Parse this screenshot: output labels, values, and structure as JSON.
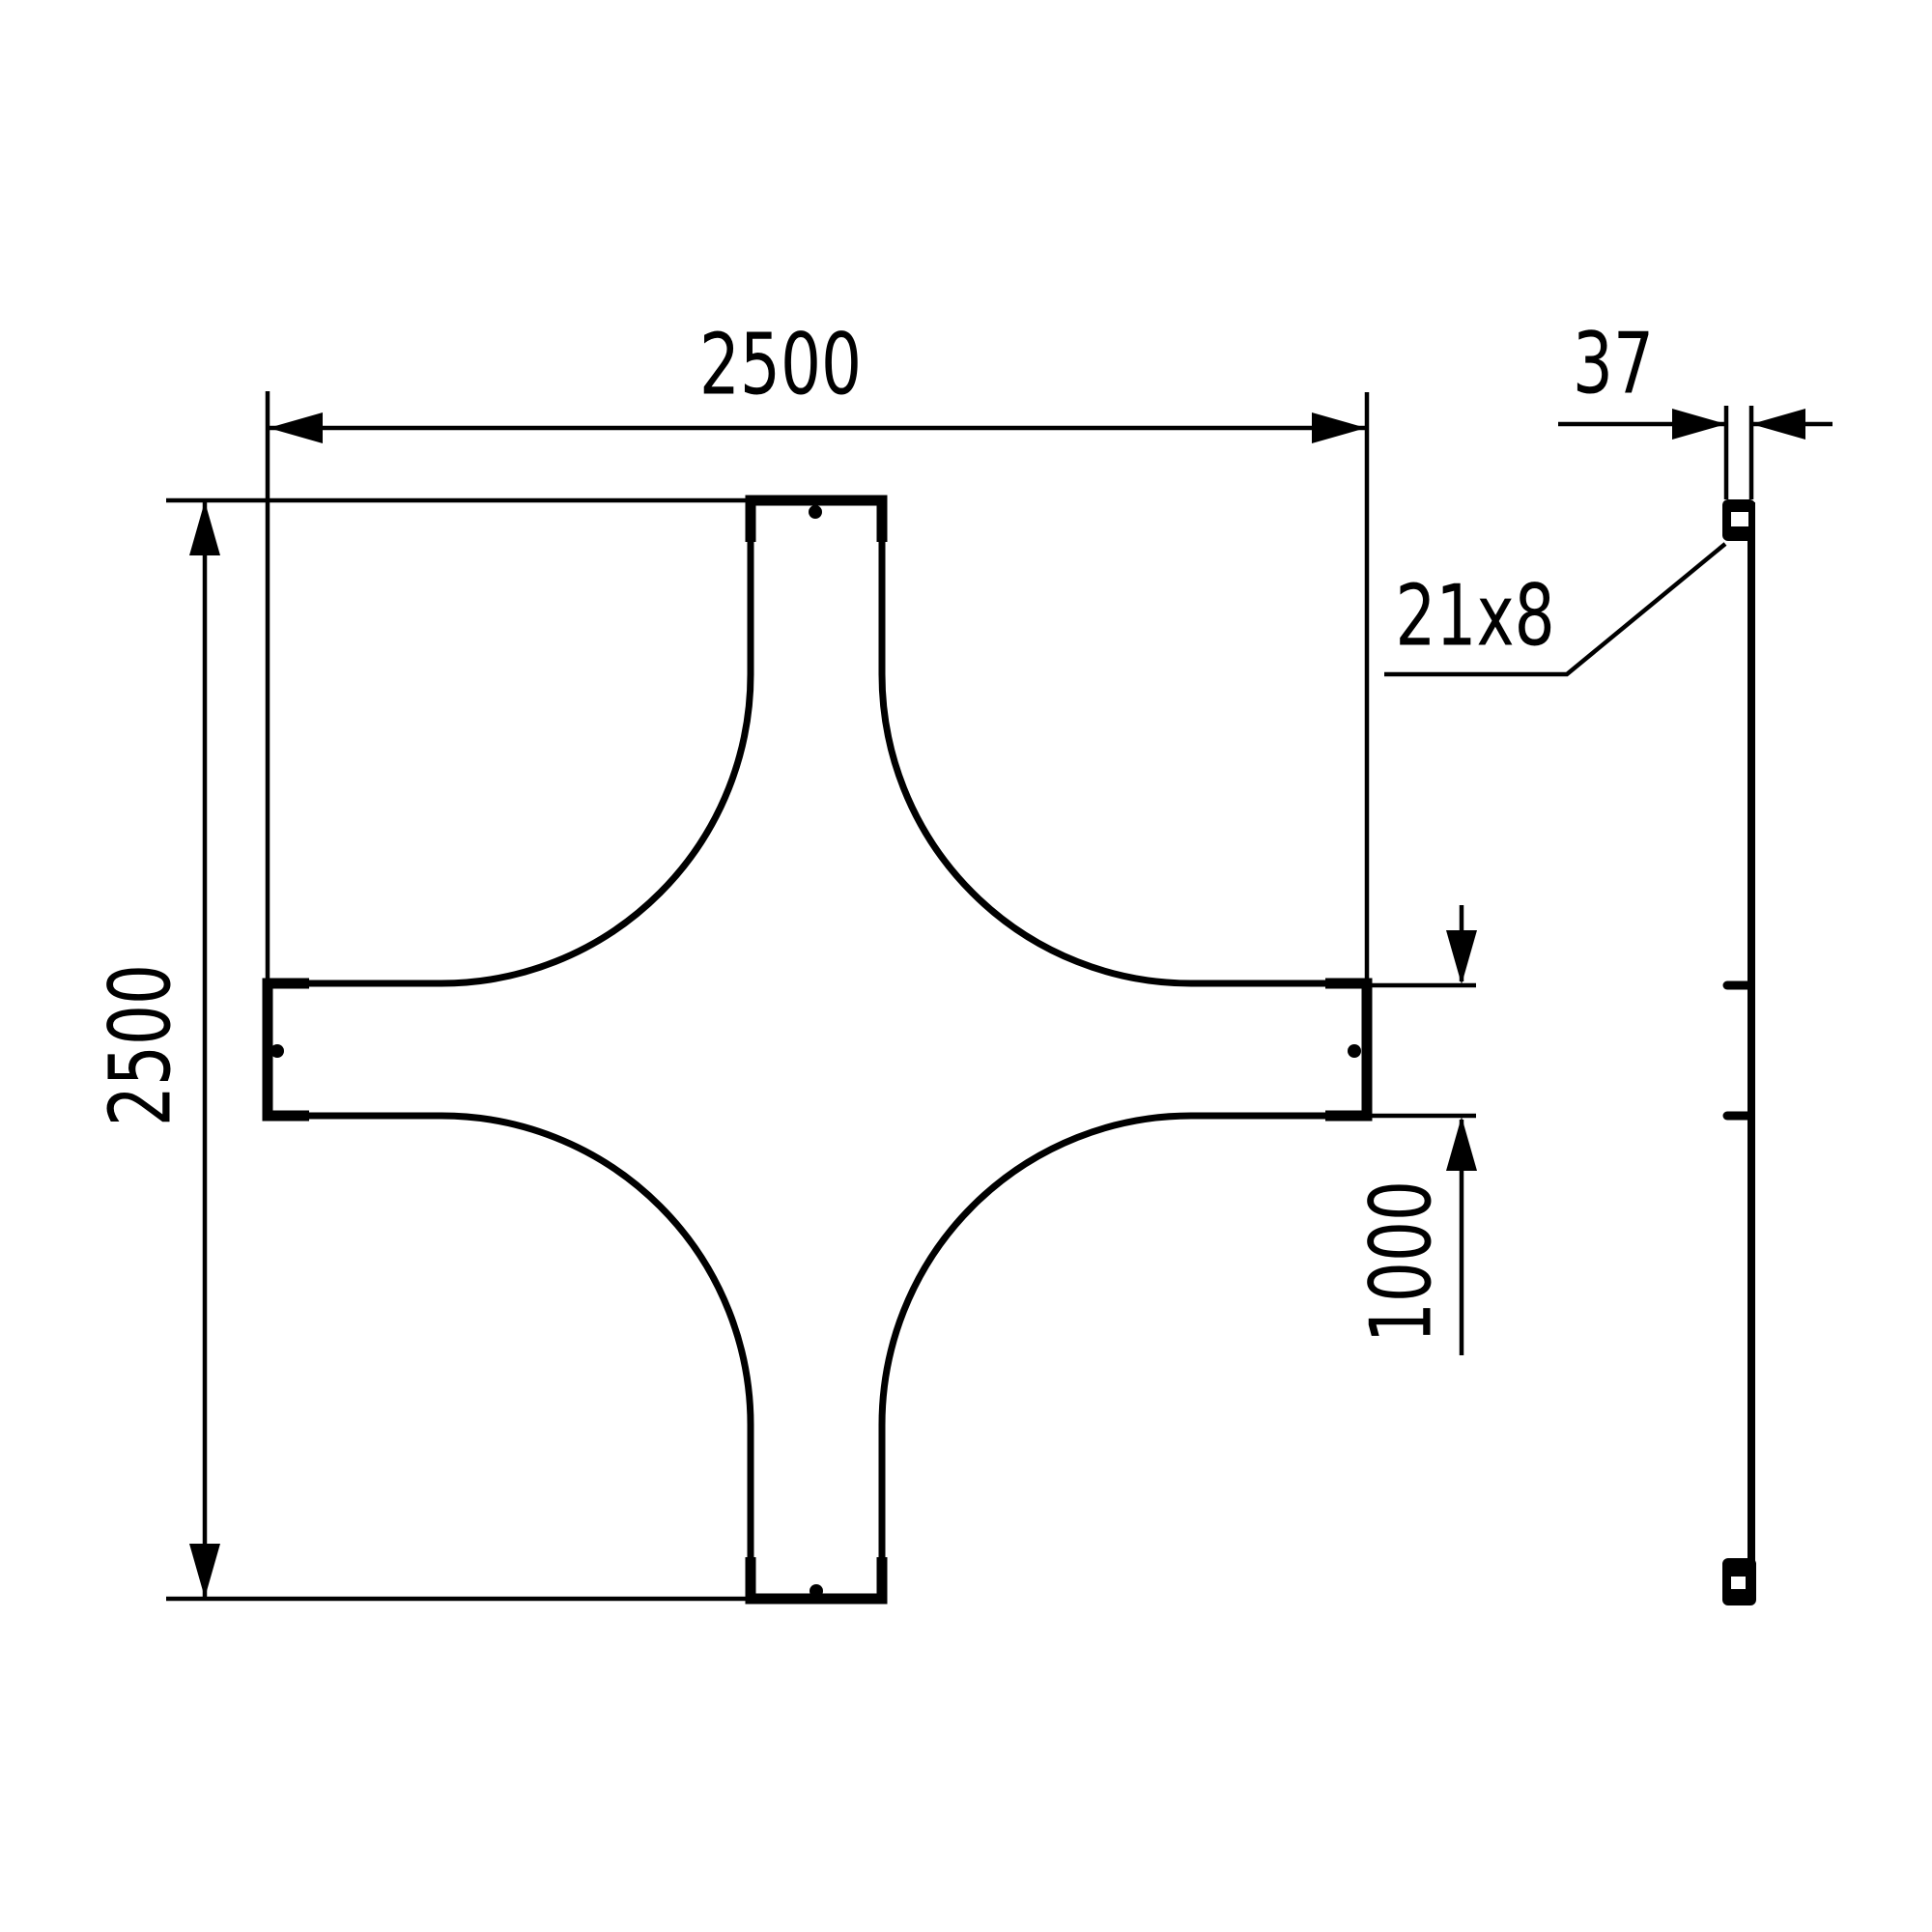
{
  "drawing": {
    "background_color": "#ffffff",
    "line_color": "#000000",
    "labels": {
      "overall_width": "2500",
      "overall_height": "2500",
      "profile_depth": "37",
      "slot_size": "21x8",
      "branch_width": "1000"
    }
  }
}
